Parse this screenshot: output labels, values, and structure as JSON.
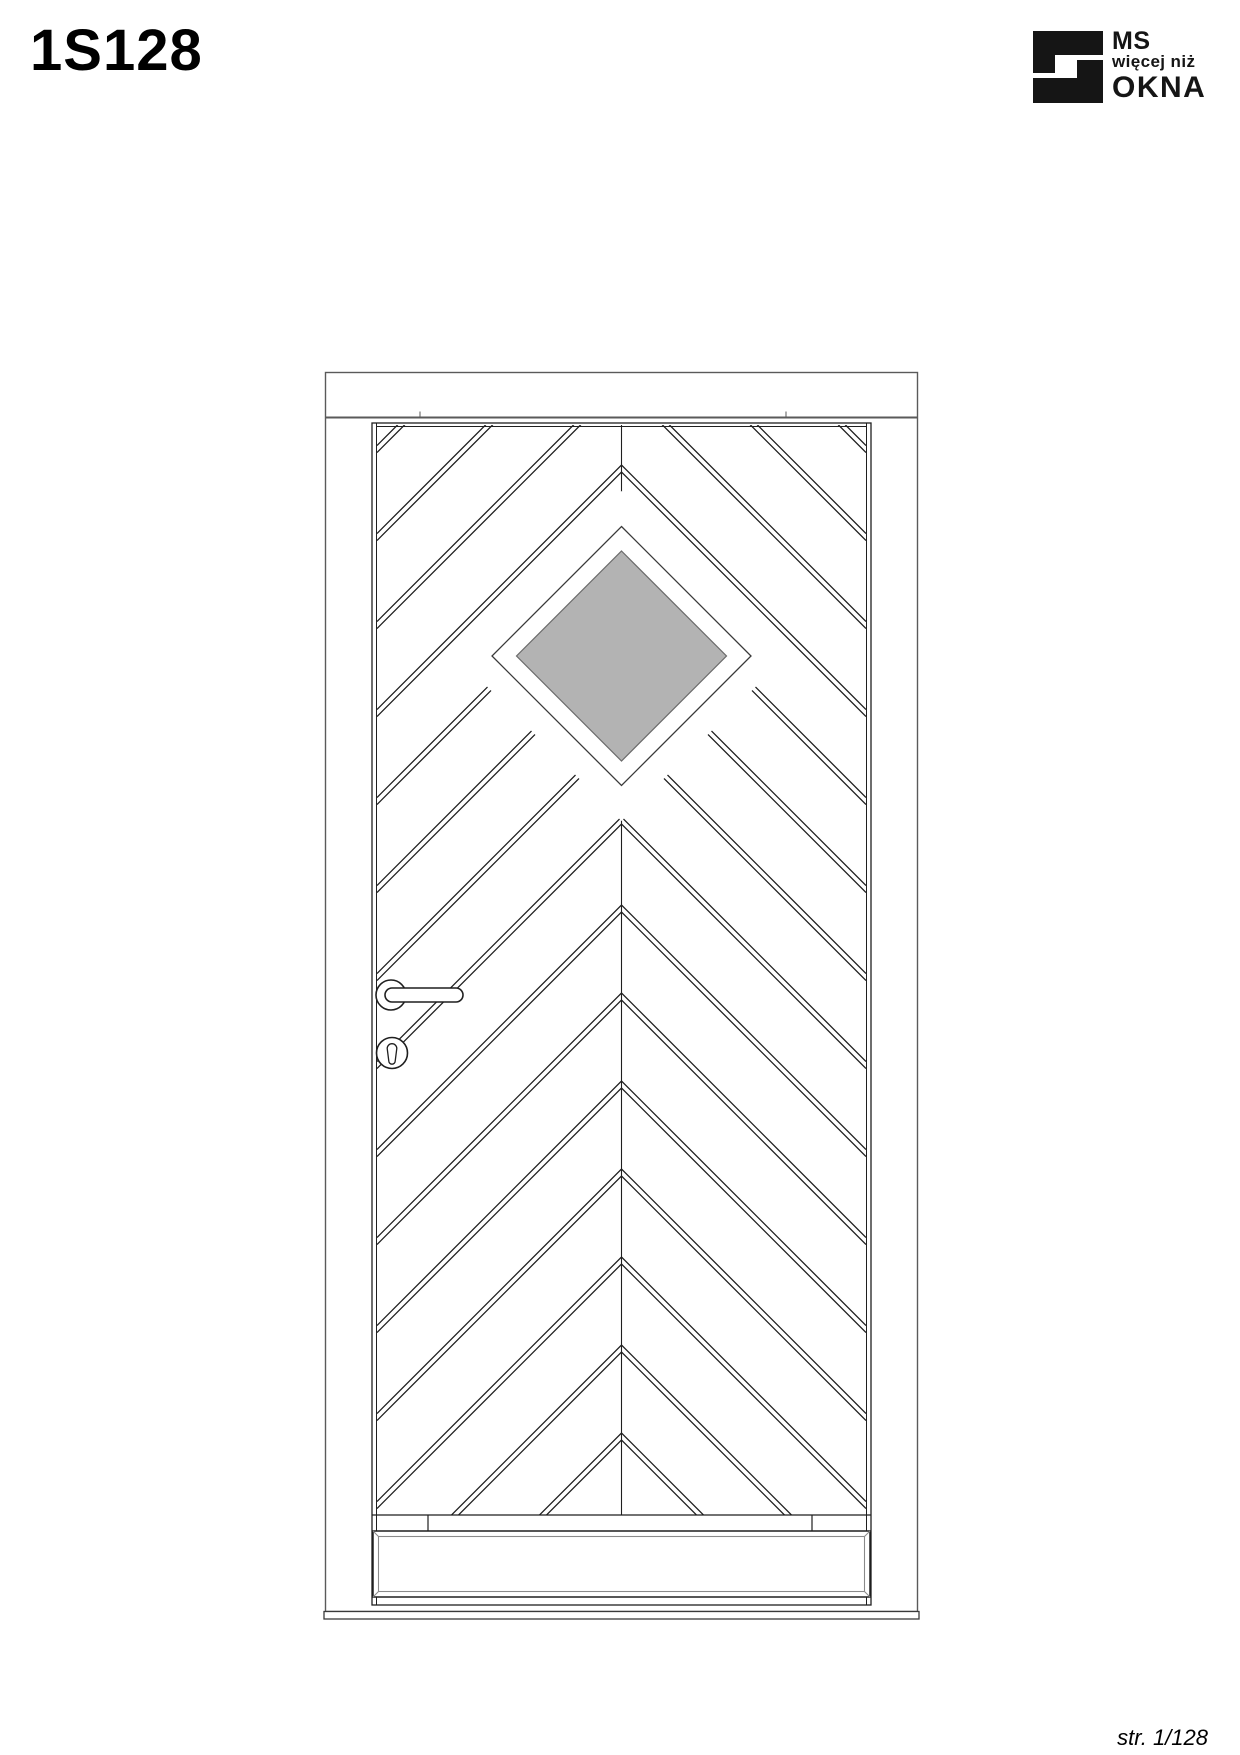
{
  "page": {
    "title": "1S128",
    "page_number": "str. 1/128"
  },
  "logo": {
    "line1": "MS",
    "line2": "więcej niż",
    "line3": "OKNA",
    "color": "#151515"
  },
  "drawing": {
    "door_model": "1S128",
    "glass_color": "#b3b3b3",
    "line_color": "#1f1f1f",
    "frame_color": "#5a5a5a",
    "panel_edge_color": "#8a8a8a",
    "sill_color": "#3a3a3a"
  }
}
